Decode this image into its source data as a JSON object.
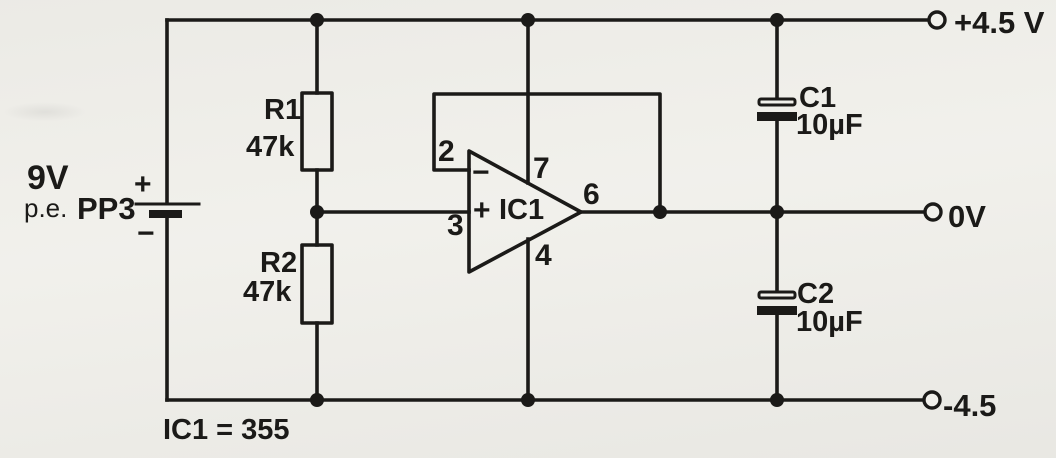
{
  "colors": {
    "ink": "#1b1a18",
    "paper": "#f1f0eb"
  },
  "battery": {
    "voltage": "9V",
    "example_prefix": "p.e.",
    "type": "PP3",
    "plus_sign": "+",
    "minus_sign": "−"
  },
  "resistors": {
    "r1": {
      "ref": "R1",
      "value": "47k"
    },
    "r2": {
      "ref": "R2",
      "value": "47k"
    }
  },
  "capacitors": {
    "c1": {
      "ref": "C1",
      "value": "10µF"
    },
    "c2": {
      "ref": "C2",
      "value": "10µF"
    }
  },
  "opamp": {
    "ref": "IC1",
    "plus_sign": "+",
    "minus_sign": "−",
    "pins": {
      "inverting": "2",
      "noninverting": "3",
      "vplus": "7",
      "output": "6",
      "vminus": "4"
    }
  },
  "terminals": {
    "positive": "+4.5 V",
    "zero": "0V",
    "negative": "-4.5"
  },
  "note": "IC1 = 355"
}
